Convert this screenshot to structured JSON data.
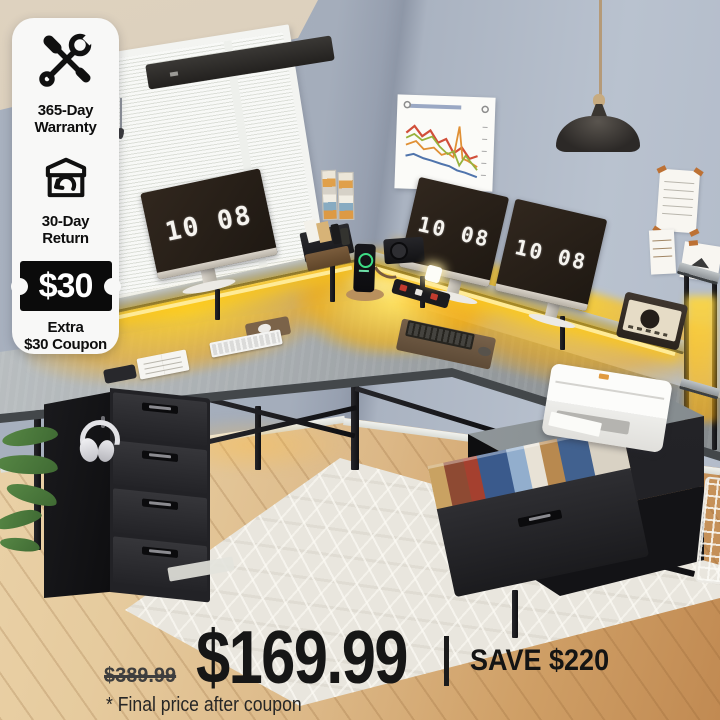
{
  "overlay": {
    "badges": [
      {
        "icon": "tools-icon",
        "line1": "365-Day",
        "line2": "Warranty"
      },
      {
        "icon": "return-box-icon",
        "line1": "30-Day",
        "line2": "Return"
      },
      {
        "icon": "coupon-icon",
        "value": "$30",
        "line1": "Extra",
        "line2": "$30 Coupon"
      }
    ],
    "price": {
      "original": "$389.99",
      "current": "$169.99",
      "save": "SAVE $220",
      "note": "* Final price after coupon"
    }
  },
  "scene": {
    "monitors": [
      {
        "clock": "10 08"
      },
      {
        "clock": "10 08"
      },
      {
        "clock": "10 08"
      }
    ],
    "colors": {
      "led_glow": "#ffc400",
      "coupon_bg": "#0b0b0b",
      "price_text": "#161616",
      "desk_top": "#a9aeb1"
    }
  }
}
